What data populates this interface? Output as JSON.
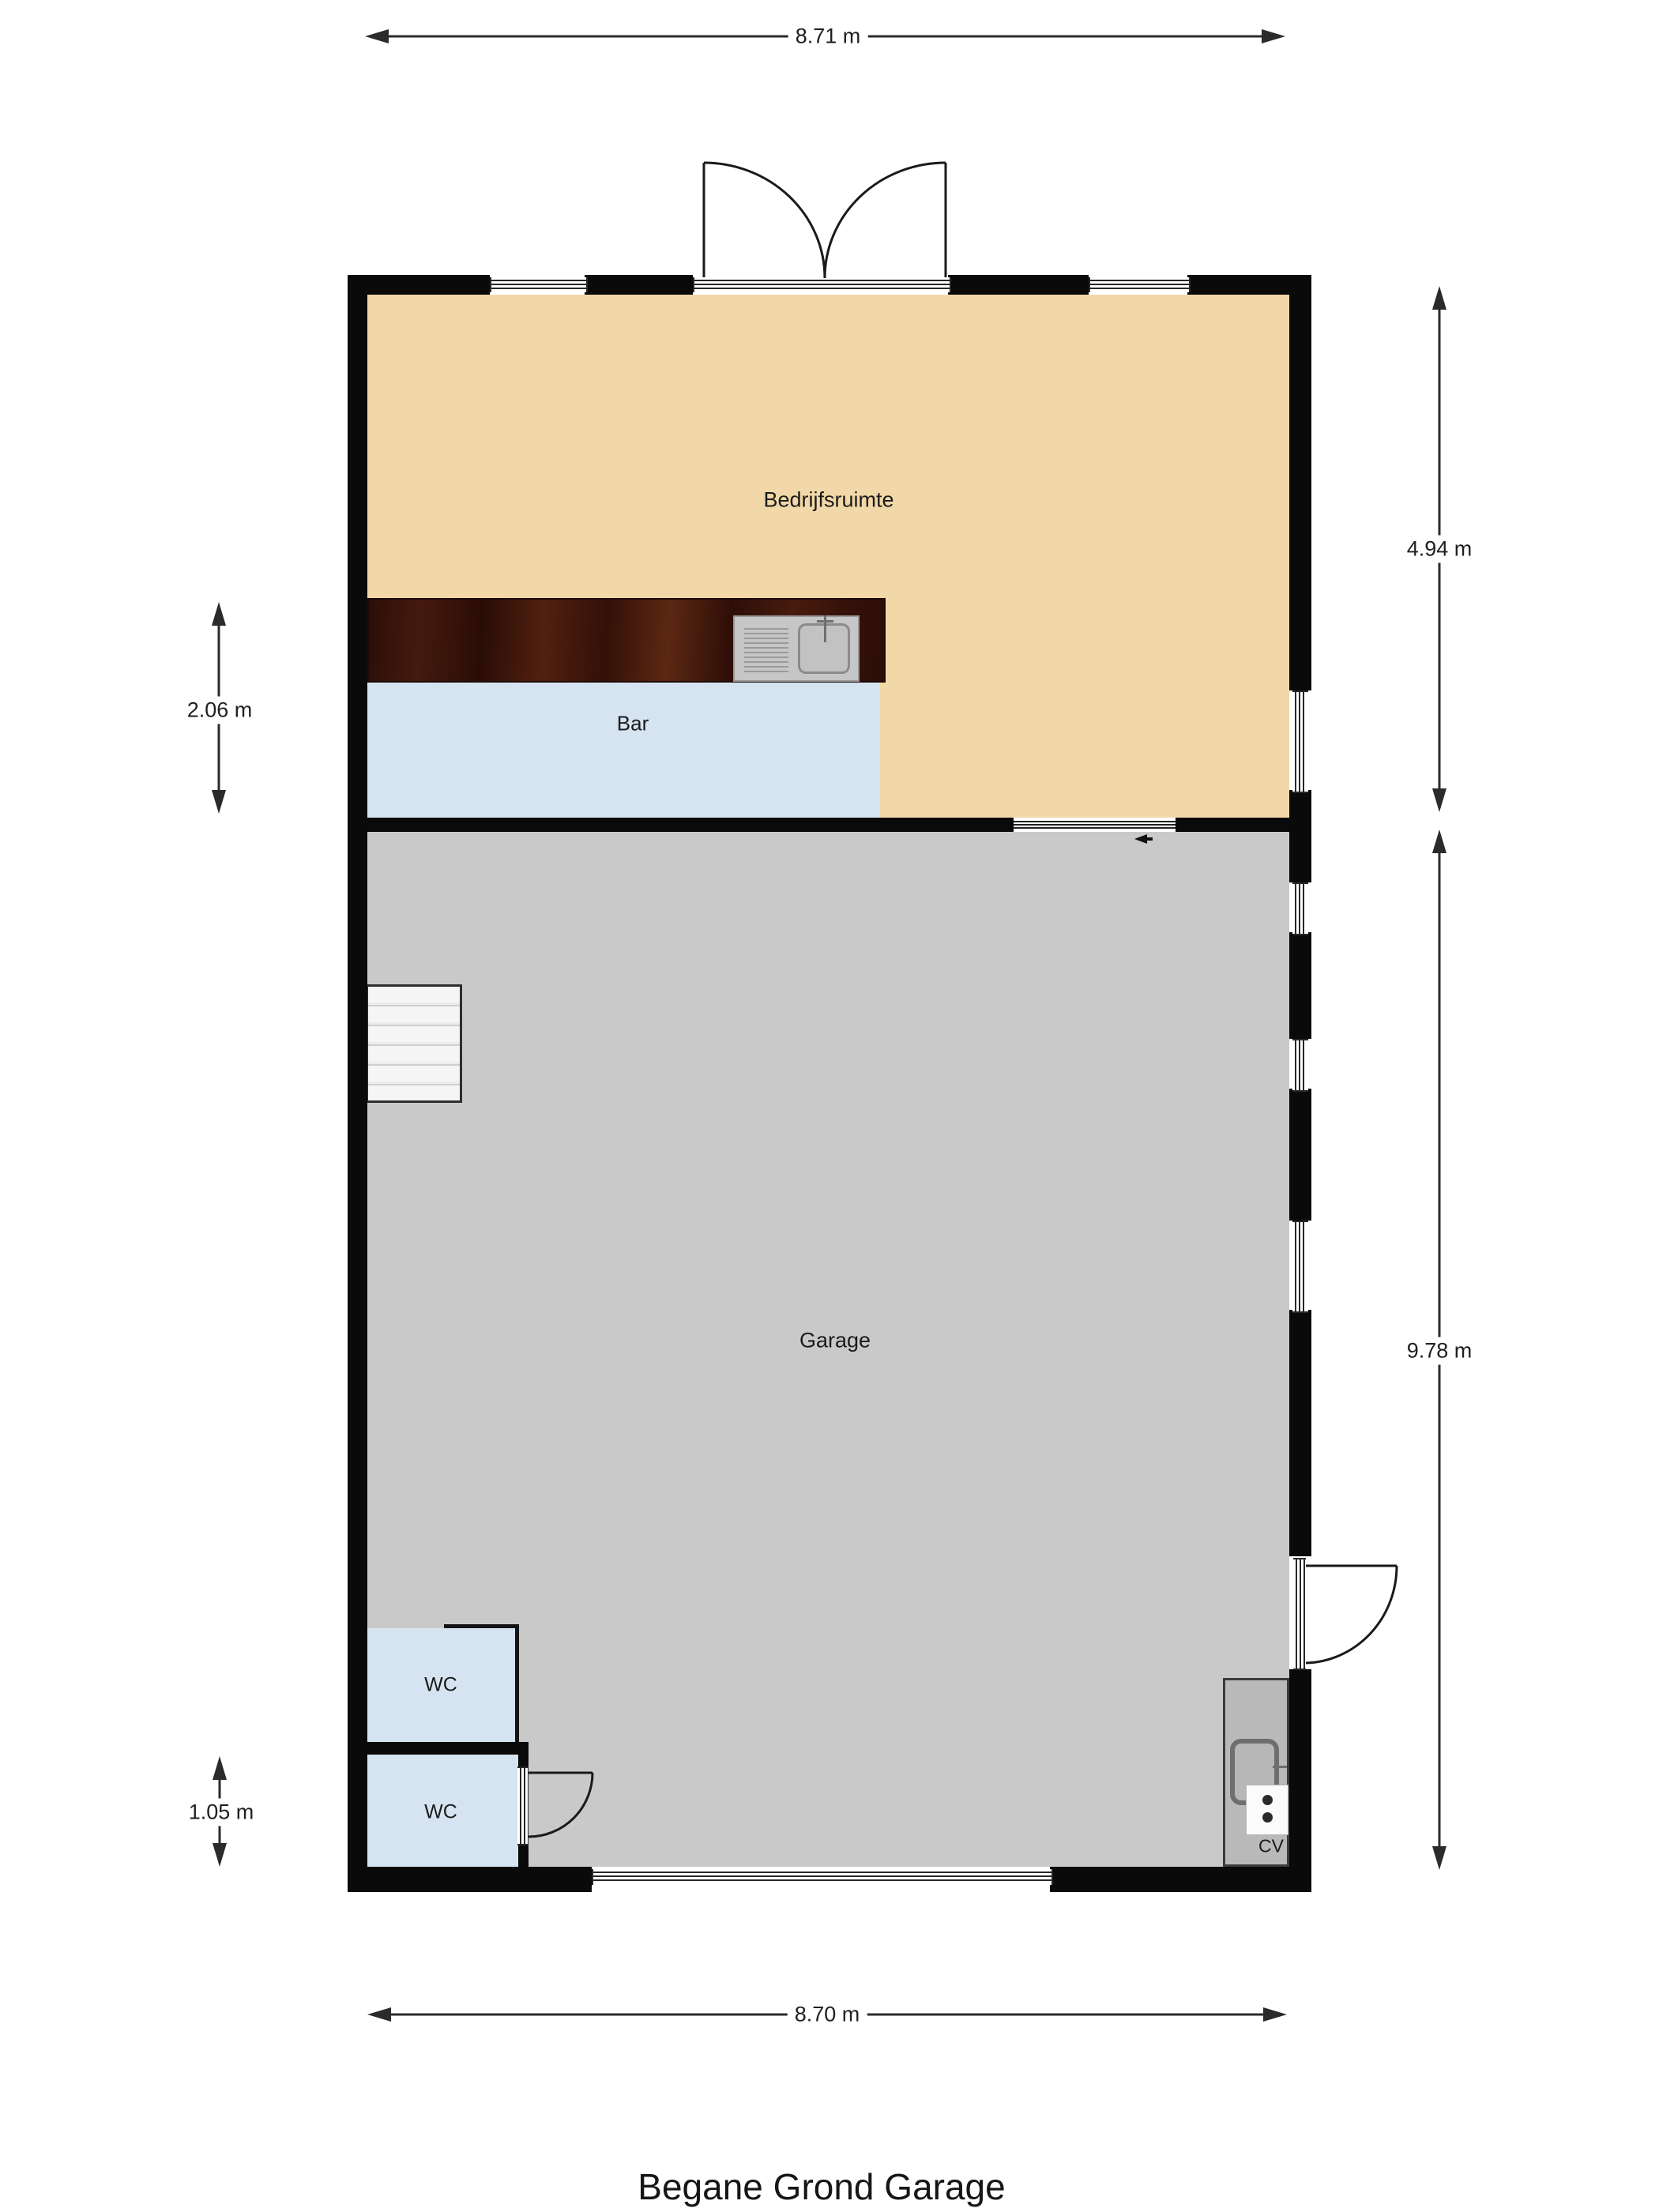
{
  "title": "Begane Grond Garage",
  "rooms": {
    "bedrijfsruimte": {
      "label": "Bedrijfsruimte"
    },
    "bar": {
      "label": "Bar"
    },
    "garage": {
      "label": "Garage"
    },
    "wc_upper": {
      "label": "WC"
    },
    "wc_lower": {
      "label": "WC"
    },
    "cv": {
      "label": "CV"
    }
  },
  "dimensions": {
    "top_width": "8.71 m",
    "bottom_width": "8.70 m",
    "bedrijfsruimte_height": "4.94 m",
    "garage_height": "9.78 m",
    "bar_height": "2.06 m",
    "wc_height": "1.05 m"
  },
  "colors": {
    "wall": "#0A0A0A",
    "bedrijfsruimte_floor": "#F2D8A8",
    "bar_floor": "#D6E4F1",
    "garage_floor": "#C9C9C9",
    "wc_floor": "#D6E4F1",
    "cv_closet": "#B9B9B9",
    "bar_counter_wood": "#3B150C",
    "stairs": "#F3F3F3"
  }
}
